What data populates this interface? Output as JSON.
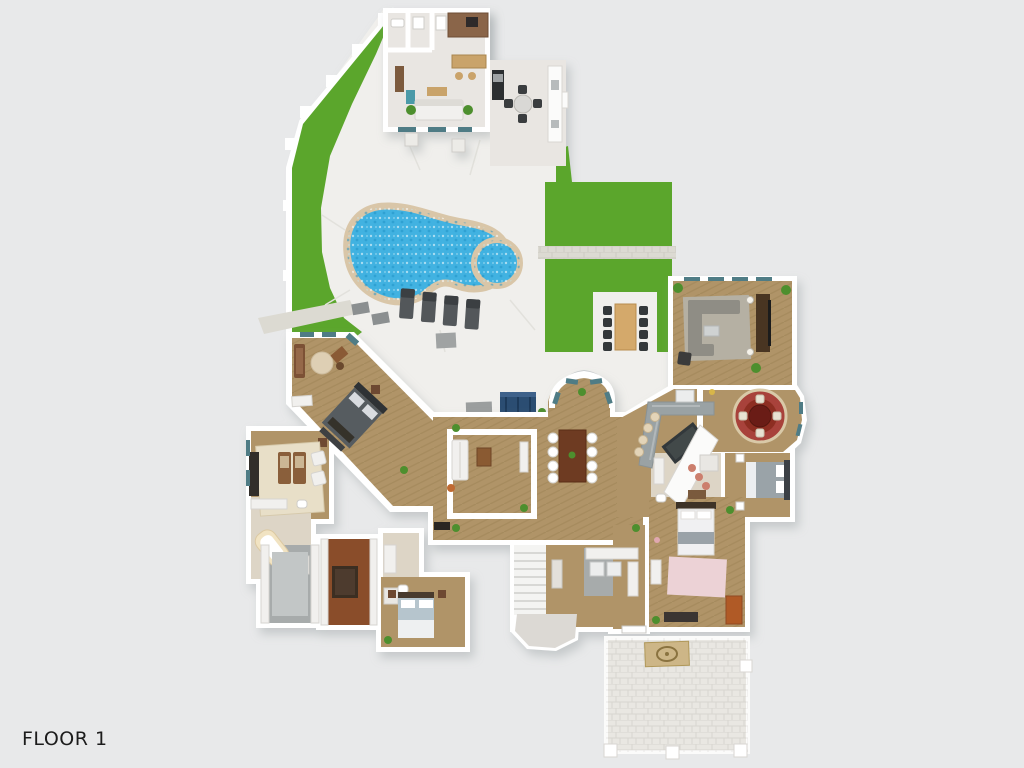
{
  "page": {
    "background_color": "#e8e9ea",
    "floor_label": "FLOOR 1",
    "floor_label_color": "#1c1c1c"
  },
  "floorplan": {
    "view": "3d-top-down-rendered-floor-plan",
    "colors": {
      "lawn": "#5ba62c",
      "patio": "#f0efec",
      "paver_path": "#dcdad2",
      "pool_water": "#41b2e1",
      "pool_coping": "#d9c6a8",
      "walls": "#ffffff",
      "floor_wood": "#b09467",
      "floor_wood_dark": "#8a4e2c",
      "floor_tile": "#ddd5c6",
      "floor_tile_light": "#e9e6e2",
      "floor_gray": "#a7abab",
      "driveway": "#e9e7e2",
      "rug_red": "#a8433a",
      "rug_cream": "#e8dfc8",
      "sofa_navy": "#2b4d72",
      "accent_orange": "#b05a28"
    },
    "outdoor_features": [
      "pool-house",
      "outdoor-kitchen-bar",
      "grill",
      "patio-dining-set",
      "swimming-pool",
      "spa",
      "lounge-chairs",
      "lawn",
      "paver-walkways",
      "outdoor-sofa",
      "outdoor-dining-table",
      "garden-fence",
      "driveway-courtyard",
      "entry-emblem-mat"
    ],
    "rooms": [
      "office-nook",
      "master-bedroom",
      "sitting-room",
      "master-bathroom",
      "walk-in-closet-carpet",
      "walk-in-closet-wood",
      "guest-bathroom",
      "guest-bedroom",
      "living-room",
      "dining-room",
      "morning-room-bay",
      "foyer-stairs",
      "laundry-mudroom",
      "kitchen",
      "breakfast-nook",
      "family-room",
      "bedroom-2",
      "bedroom-3",
      "bathroom-2",
      "hallway"
    ]
  }
}
